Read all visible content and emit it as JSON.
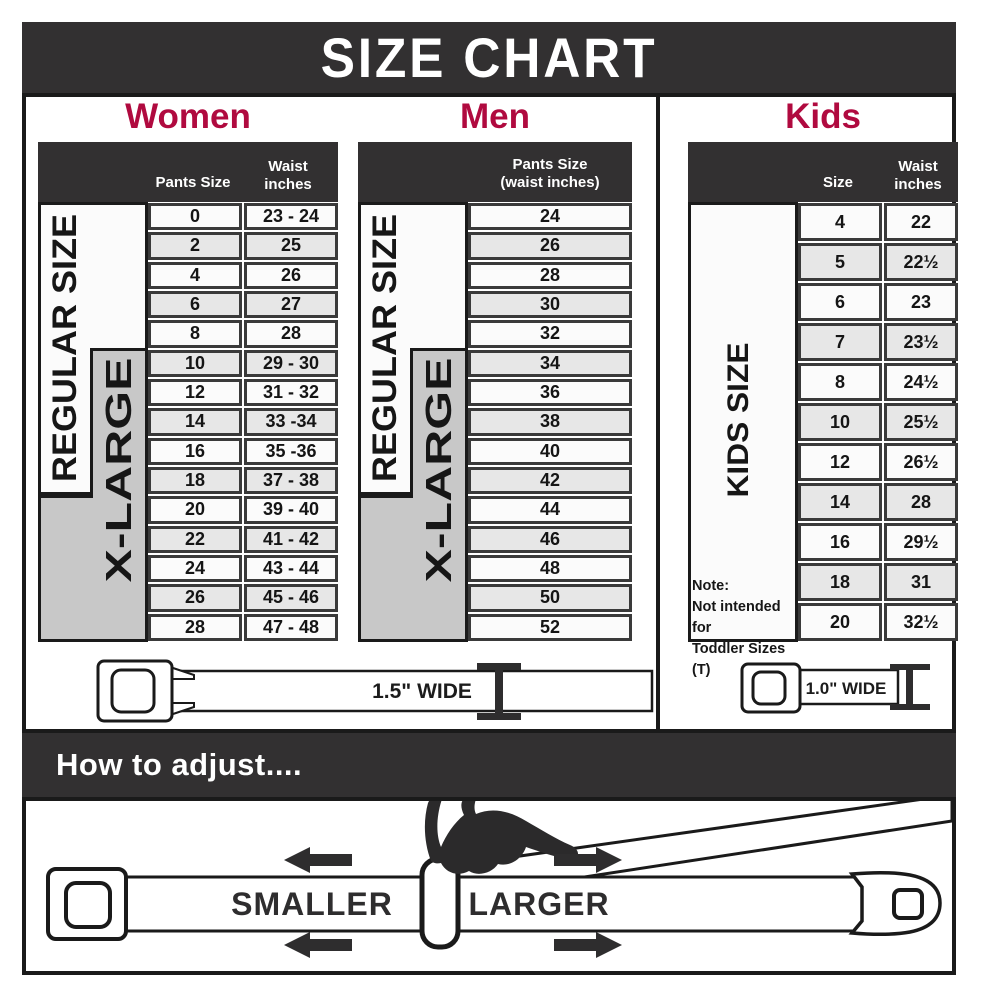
{
  "title": "SIZE CHART",
  "colors": {
    "accent": "#b00a3f",
    "dark": "#323031",
    "ink": "#1a1a1a",
    "xlarge_gray": "#c8c8c8",
    "row_alt": "#e7e7e7",
    "row_base": "#fbfbfb",
    "cell_border": "#3a3a3a"
  },
  "side_labels": {
    "regular": "REGULAR SIZE",
    "xlarge": "X-LARGE"
  },
  "women": {
    "label": "Women",
    "header": {
      "size": "Pants Size",
      "waist": "Waist\ninches"
    },
    "rows": [
      {
        "size": "0",
        "waist": "23 - 24"
      },
      {
        "size": "2",
        "waist": "25"
      },
      {
        "size": "4",
        "waist": "26"
      },
      {
        "size": "6",
        "waist": "27"
      },
      {
        "size": "8",
        "waist": "28"
      },
      {
        "size": "10",
        "waist": "29 - 30"
      },
      {
        "size": "12",
        "waist": "31 - 32"
      },
      {
        "size": "14",
        "waist": "33 -34"
      },
      {
        "size": "16",
        "waist": "35 -36"
      },
      {
        "size": "18",
        "waist": "37 - 38"
      },
      {
        "size": "20",
        "waist": "39 - 40"
      },
      {
        "size": "22",
        "waist": "41 - 42"
      },
      {
        "size": "24",
        "waist": "43 - 44"
      },
      {
        "size": "26",
        "waist": "45 - 46"
      },
      {
        "size": "28",
        "waist": "47 - 48"
      }
    ]
  },
  "men": {
    "label": "Men",
    "header": {
      "col": "Pants Size\n(waist inches)"
    },
    "rows": [
      "24",
      "26",
      "28",
      "30",
      "32",
      "34",
      "36",
      "38",
      "40",
      "42",
      "44",
      "46",
      "48",
      "50",
      "52"
    ]
  },
  "kids": {
    "label": "Kids",
    "header": {
      "size": "Size",
      "waist": "Waist\ninches"
    },
    "side_label": "KIDS SIZE",
    "note_lines": [
      "Note:",
      "Not intended for",
      "Toddler Sizes (T)"
    ],
    "rows": [
      {
        "size": "4",
        "waist": "22"
      },
      {
        "size": "5",
        "waist": "22½"
      },
      {
        "size": "6",
        "waist": "23"
      },
      {
        "size": "7",
        "waist": "23½"
      },
      {
        "size": "8",
        "waist": "24½"
      },
      {
        "size": "10",
        "waist": "25½"
      },
      {
        "size": "12",
        "waist": "26½"
      },
      {
        "size": "14",
        "waist": "28"
      },
      {
        "size": "16",
        "waist": "29½"
      },
      {
        "size": "18",
        "waist": "31"
      },
      {
        "size": "20",
        "waist": "32½"
      }
    ]
  },
  "belts": {
    "adult_width": "1.5\" WIDE",
    "kids_width": "1.0\" WIDE"
  },
  "adjust": {
    "heading": "How to adjust....",
    "smaller": "SMALLER",
    "larger": "LARGER"
  }
}
